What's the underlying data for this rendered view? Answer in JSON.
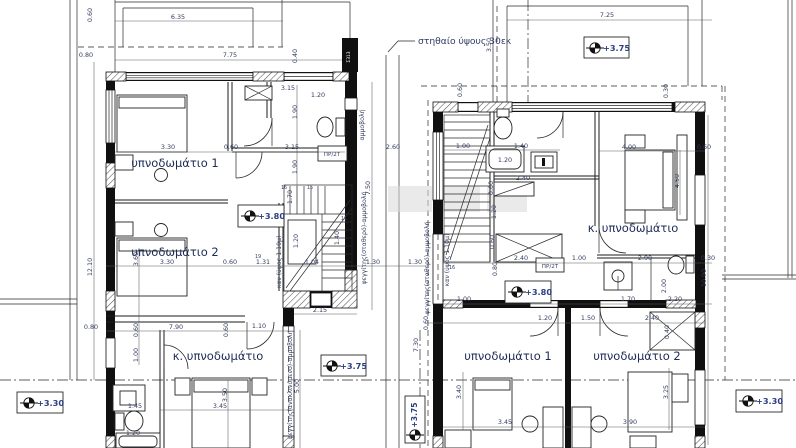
{
  "annotations": {
    "parapet_note": "στηθαίο ύψους 30εκ",
    "shaft_label": "Σ313",
    "railing_note_left": "καν (ύψος 1.10μ)",
    "railing_note_right": "καν (ύψος 1.10μ)"
  },
  "rooms": {
    "left_unit": [
      "υπνοδωμάτιο 1",
      "υπνοδωμάτιο 2",
      "κ. υπνοδωμάτιο"
    ],
    "right_unit": [
      "κ. υπνοδωμάτιο",
      "υπνοδωμάτιο 1",
      "υπνοδωμάτιο 2"
    ]
  },
  "fixture_labels": {
    "pr2t_left": "ΠΡ/2Τ",
    "pr2t_right": "ΠΡ/2Τ"
  },
  "wall_texts": {
    "ammovoli": "αμμοβολή",
    "fegitis_statho_left": "φεγγίτης(σταθερό)-αμμοβολή",
    "fegitis_statho_right": "φεγγίτης(σταθερό)-αμμοβολή",
    "fegitis_anaklinomeno": "φεγγίτης(ανακλινόμενο)-αμμοβολή"
  },
  "levels": [
    {
      "value": "+3.75"
    },
    {
      "value": "+3.75"
    },
    {
      "value": "+3.75"
    },
    {
      "value": "+3.80"
    },
    {
      "value": "+3.80"
    },
    {
      "value": "+3.30"
    },
    {
      "value": "+3.30"
    }
  ],
  "colors": {
    "line": "#1b1b1b",
    "annotation_text": "#333c5e",
    "room_label": "#1e2a55",
    "level_text": "#2c3e80"
  },
  "dims": [
    {
      "t": "6.35",
      "x": 178,
      "y": 19,
      "o": "h"
    },
    {
      "t": "0.60",
      "x": 92,
      "y": 15,
      "o": "v"
    },
    {
      "t": "0.80",
      "x": 86,
      "y": 57,
      "o": "h"
    },
    {
      "t": "7.75",
      "x": 230,
      "y": 57,
      "o": "h"
    },
    {
      "t": "0.40",
      "x": 297,
      "y": 56,
      "o": "v"
    },
    {
      "t": "7.25",
      "x": 607,
      "y": 17,
      "o": "h"
    },
    {
      "t": "3.50",
      "x": 491,
      "y": 45,
      "o": "v"
    },
    {
      "t": "0.60",
      "x": 462,
      "y": 90,
      "o": "v"
    },
    {
      "t": "0.30",
      "x": 668,
      "y": 91,
      "o": "v"
    },
    {
      "t": "3.15",
      "x": 288,
      "y": 90,
      "o": "h"
    },
    {
      "t": "1.20",
      "x": 318,
      "y": 97,
      "o": "h"
    },
    {
      "t": "1.90",
      "x": 297,
      "y": 112,
      "o": "v"
    },
    {
      "t": "3.30",
      "x": 168,
      "y": 149,
      "o": "h"
    },
    {
      "t": "0.60",
      "x": 231,
      "y": 149,
      "o": "h"
    },
    {
      "t": "3.15",
      "x": 292,
      "y": 149,
      "o": "h"
    },
    {
      "t": "1.90",
      "x": 297,
      "y": 167,
      "o": "v"
    },
    {
      "t": "1.70",
      "x": 292,
      "y": 197,
      "o": "v"
    },
    {
      "t": "1.20",
      "x": 298,
      "y": 241,
      "o": "v"
    },
    {
      "t": "1.40",
      "x": 339,
      "y": 238,
      "o": "v"
    },
    {
      "t": "7.50",
      "x": 370,
      "y": 188,
      "o": "v"
    },
    {
      "t": "2.60",
      "x": 393,
      "y": 149,
      "o": "h"
    },
    {
      "t": "1.30",
      "x": 373,
      "y": 264,
      "o": "h"
    },
    {
      "t": "1.30",
      "x": 415,
      "y": 264,
      "o": "h"
    },
    {
      "t": "12.10",
      "x": 92,
      "y": 267,
      "o": "v"
    },
    {
      "t": "3.60",
      "x": 138,
      "y": 259,
      "o": "v"
    },
    {
      "t": "3.30",
      "x": 167,
      "y": 264,
      "o": "h"
    },
    {
      "t": "0.60",
      "x": 230,
      "y": 264,
      "o": "h"
    },
    {
      "t": "1.31",
      "x": 263,
      "y": 264,
      "o": "h"
    },
    {
      "t": "1.04",
      "x": 312,
      "y": 264,
      "o": "h"
    },
    {
      "t": "0.80",
      "x": 91,
      "y": 329,
      "o": "h"
    },
    {
      "t": "0.60",
      "x": 138,
      "y": 330,
      "o": "v"
    },
    {
      "t": "7.90",
      "x": 176,
      "y": 329,
      "o": "h"
    },
    {
      "t": "0.60",
      "x": 228,
      "y": 330,
      "o": "v"
    },
    {
      "t": "1.10",
      "x": 259,
      "y": 328,
      "o": "h"
    },
    {
      "t": "2.15",
      "x": 320,
      "y": 312,
      "o": "h"
    },
    {
      "t": "1.00",
      "x": 138,
      "y": 355,
      "o": "v"
    },
    {
      "t": "3.50",
      "x": 227,
      "y": 395,
      "o": "v"
    },
    {
      "t": "3.45",
      "x": 220,
      "y": 408,
      "o": "h"
    },
    {
      "t": "1.45",
      "x": 135,
      "y": 408,
      "o": "h"
    },
    {
      "t": "1.20",
      "x": 133,
      "y": 435,
      "o": "h"
    },
    {
      "t": "5.00",
      "x": 299,
      "y": 386,
      "o": "v"
    },
    {
      "t": "7.30",
      "x": 418,
      "y": 345,
      "o": "v"
    },
    {
      "t": "1.00",
      "x": 463,
      "y": 148,
      "o": "h"
    },
    {
      "t": "1.40",
      "x": 521,
      "y": 148,
      "o": "h"
    },
    {
      "t": "1.20",
      "x": 505,
      "y": 162,
      "o": "h"
    },
    {
      "t": "2.40",
      "x": 523,
      "y": 180,
      "o": "h"
    },
    {
      "t": "0.60",
      "x": 493,
      "y": 188,
      "o": "v"
    },
    {
      "t": "1.20",
      "x": 496,
      "y": 212,
      "o": "v"
    },
    {
      "t": "0.60",
      "x": 494,
      "y": 242,
      "o": "v"
    },
    {
      "t": "0.80",
      "x": 497,
      "y": 269,
      "o": "v"
    },
    {
      "t": "2.40",
      "x": 521,
      "y": 260,
      "o": "h"
    },
    {
      "t": "1.00",
      "x": 579,
      "y": 260,
      "o": "h"
    },
    {
      "t": "2.90",
      "x": 645,
      "y": 260,
      "o": "h"
    },
    {
      "t": "0.30",
      "x": 708,
      "y": 260,
      "o": "h"
    },
    {
      "t": "4.00",
      "x": 629,
      "y": 149,
      "o": "h"
    },
    {
      "t": "0.60",
      "x": 704,
      "y": 149,
      "o": "h"
    },
    {
      "t": "4.50",
      "x": 679,
      "y": 181,
      "o": "v"
    },
    {
      "t": "2.00",
      "x": 666,
      "y": 286,
      "o": "v"
    },
    {
      "t": "1.00",
      "x": 464,
      "y": 301,
      "o": "h"
    },
    {
      "t": "3.60",
      "x": 537,
      "y": 301,
      "o": "h"
    },
    {
      "t": "1.70",
      "x": 628,
      "y": 301,
      "o": "h"
    },
    {
      "t": "2.20",
      "x": 675,
      "y": 301,
      "o": "h"
    },
    {
      "t": "10.90",
      "x": 706,
      "y": 278,
      "o": "v"
    },
    {
      "t": "0.60",
      "x": 428,
      "y": 323,
      "o": "v"
    },
    {
      "t": "1.20",
      "x": 545,
      "y": 320,
      "o": "h"
    },
    {
      "t": "1.50",
      "x": 588,
      "y": 320,
      "o": "h"
    },
    {
      "t": "2.40",
      "x": 652,
      "y": 320,
      "o": "h"
    },
    {
      "t": "0.40",
      "x": 669,
      "y": 332,
      "o": "v"
    },
    {
      "t": "3.40",
      "x": 461,
      "y": 392,
      "o": "v"
    },
    {
      "t": "3.45",
      "x": 505,
      "y": 424,
      "o": "h"
    },
    {
      "t": "3.90",
      "x": 630,
      "y": 424,
      "o": "h"
    },
    {
      "t": "3.25",
      "x": 668,
      "y": 392,
      "o": "v"
    }
  ],
  "stair_numbers": [
    {
      "t": "16",
      "x": 284,
      "y": 189
    },
    {
      "t": "15",
      "x": 310,
      "y": 189
    },
    {
      "t": "11",
      "x": 344,
      "y": 220
    },
    {
      "t": "19",
      "x": 258,
      "y": 258
    },
    {
      "t": "16",
      "x": 452,
      "y": 269
    }
  ]
}
